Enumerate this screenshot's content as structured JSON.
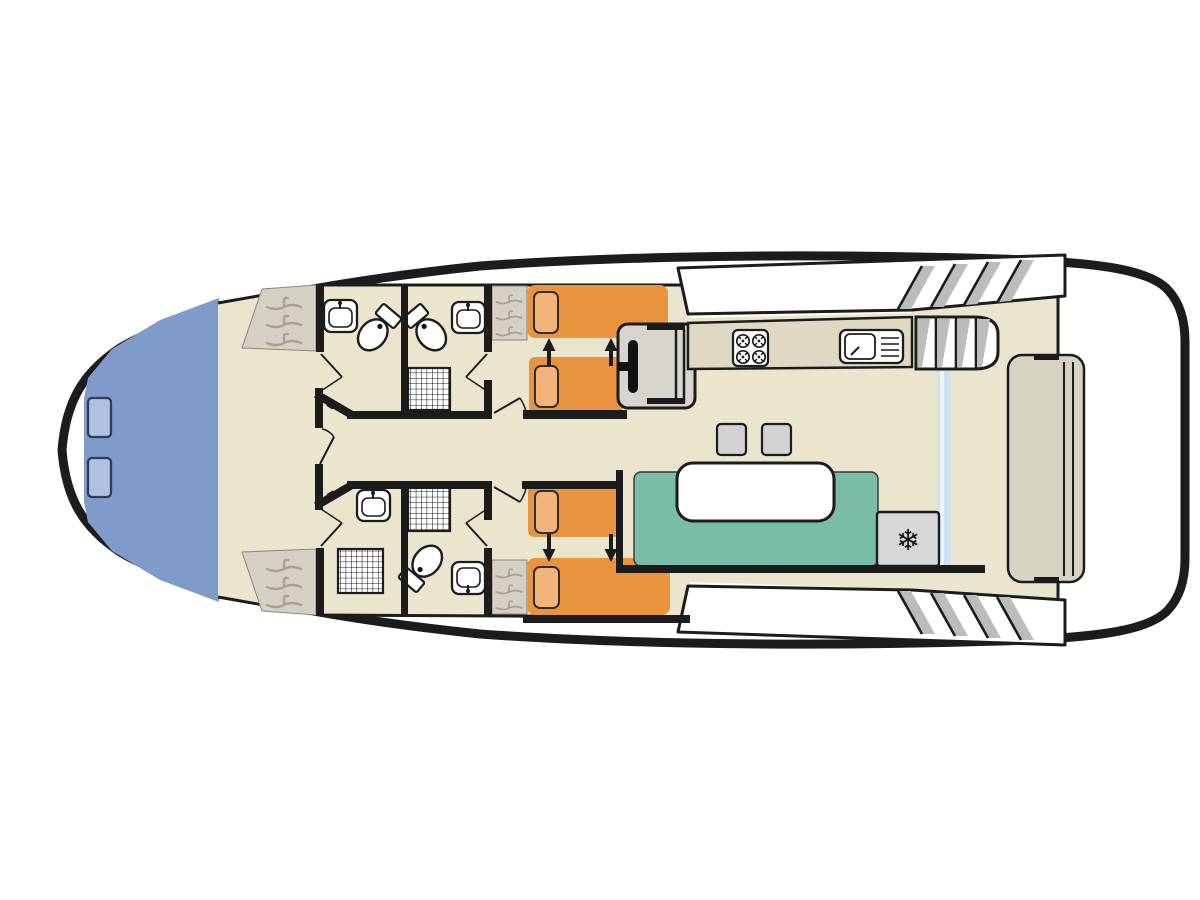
{
  "diagram": {
    "type": "houseboat-deck-floor-plan",
    "colors": {
      "hull_outline": "#1c1c1c",
      "deck_white": "#ffffff",
      "floor_beige": "#eae6ce",
      "bow_deck_blue": "#7f9bca",
      "bow_hatch_blue": "#aec1e0",
      "bed_orange": "#e9953e",
      "pillow_orange": "#f2b478",
      "sofa_teal": "#7abda6",
      "table_white": "#ffffff",
      "counter_beige": "#ddd9c3",
      "wardrobe_gray": "#d4d0c4",
      "hanger_gray": "#a9a396",
      "helm_gray": "#d8d5cf",
      "stool_gray": "#d2d2d2",
      "fridge_gray": "#d7d7d9",
      "glass_blue": "#cfe1ef",
      "step_shadow_gray": "#bcbcbc",
      "fixture_white": "#ffffff",
      "bench_beige": "#d7d3c3",
      "wall_black": "#1c1c1c",
      "icon_ink": "#111111"
    },
    "icons": {
      "freezer_glyph": "❄"
    }
  }
}
